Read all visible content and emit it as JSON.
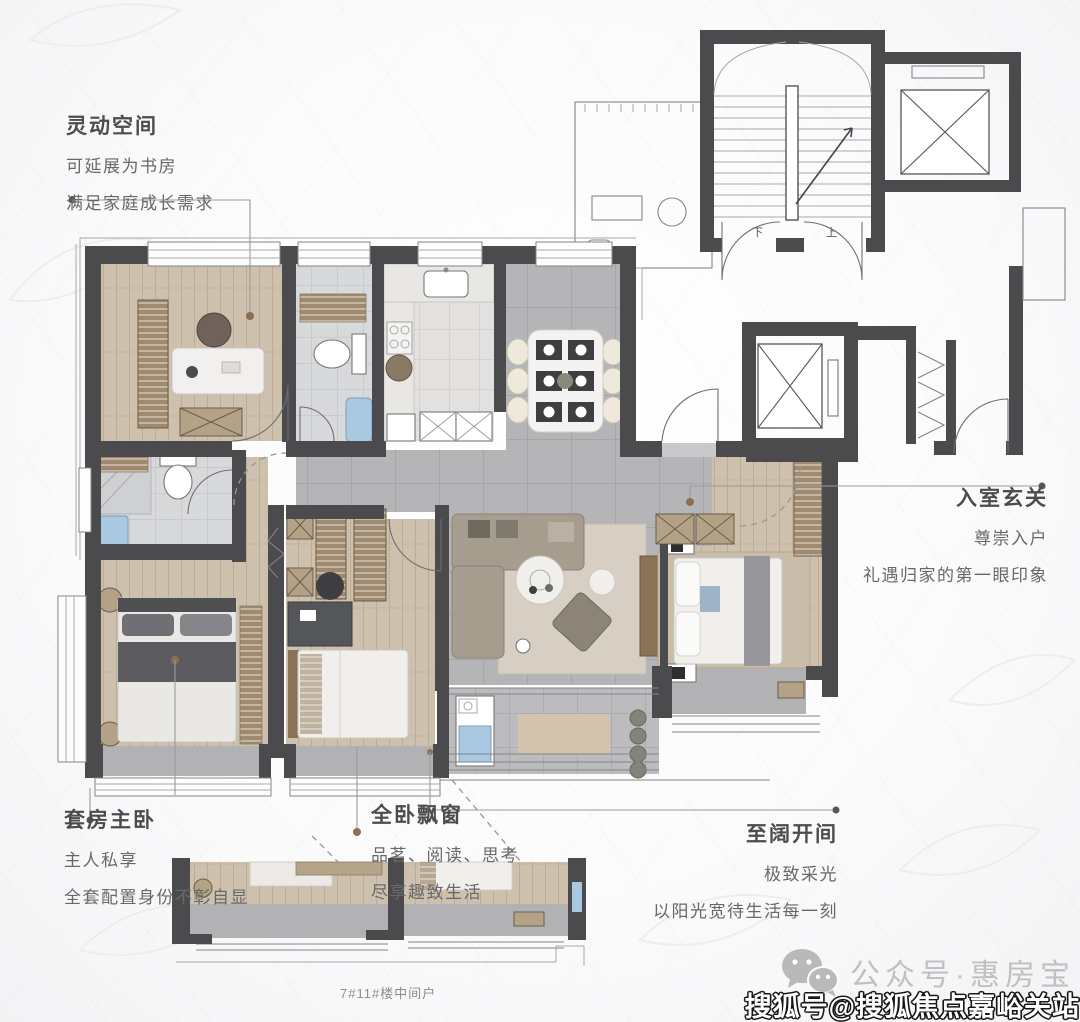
{
  "annotations": {
    "flex_space": {
      "title": "灵动空间",
      "lines": [
        "可延展为书房",
        "满足家庭成长需求"
      ]
    },
    "foyer": {
      "title": "入室玄关",
      "lines": [
        "尊崇入户",
        "礼遇归家的第一眼印象"
      ]
    },
    "master_suite": {
      "title": "套房主卧",
      "lines": [
        "主人私享",
        "全套配置身份不彰自显"
      ]
    },
    "bay_windows": {
      "title": "全卧飘窗",
      "lines": [
        "品茗、阅读、思考",
        "尽享趣致生活"
      ]
    },
    "wide_bay": {
      "title": "至阔开间",
      "lines": [
        "极致采光",
        "以阳光宽待生活每一刻"
      ]
    }
  },
  "stair": {
    "up_label": "上",
    "down_label": "下"
  },
  "caption": {
    "unit_label": "7#11#楼中间户"
  },
  "watermarks": {
    "wechat_account": "公众号·惠房宝",
    "sohu_account": "搜狐号@搜狐焦点嘉峪关站",
    "wechat_icon": "wechat-icon"
  },
  "colors": {
    "wall": "#4b4b4d",
    "wood_floor": "#cdc0ac",
    "tile_floor": "#b5b5b7",
    "bath_tile": "#d8d9da",
    "accent_blue": "#a9c8e2",
    "leader_line": "#9b9b9e",
    "leader_dot_brown": "#8a6f55",
    "title_text": "#4c4c4e",
    "body_text": "#68686a",
    "watermark_gray": "#c0c0c2"
  }
}
